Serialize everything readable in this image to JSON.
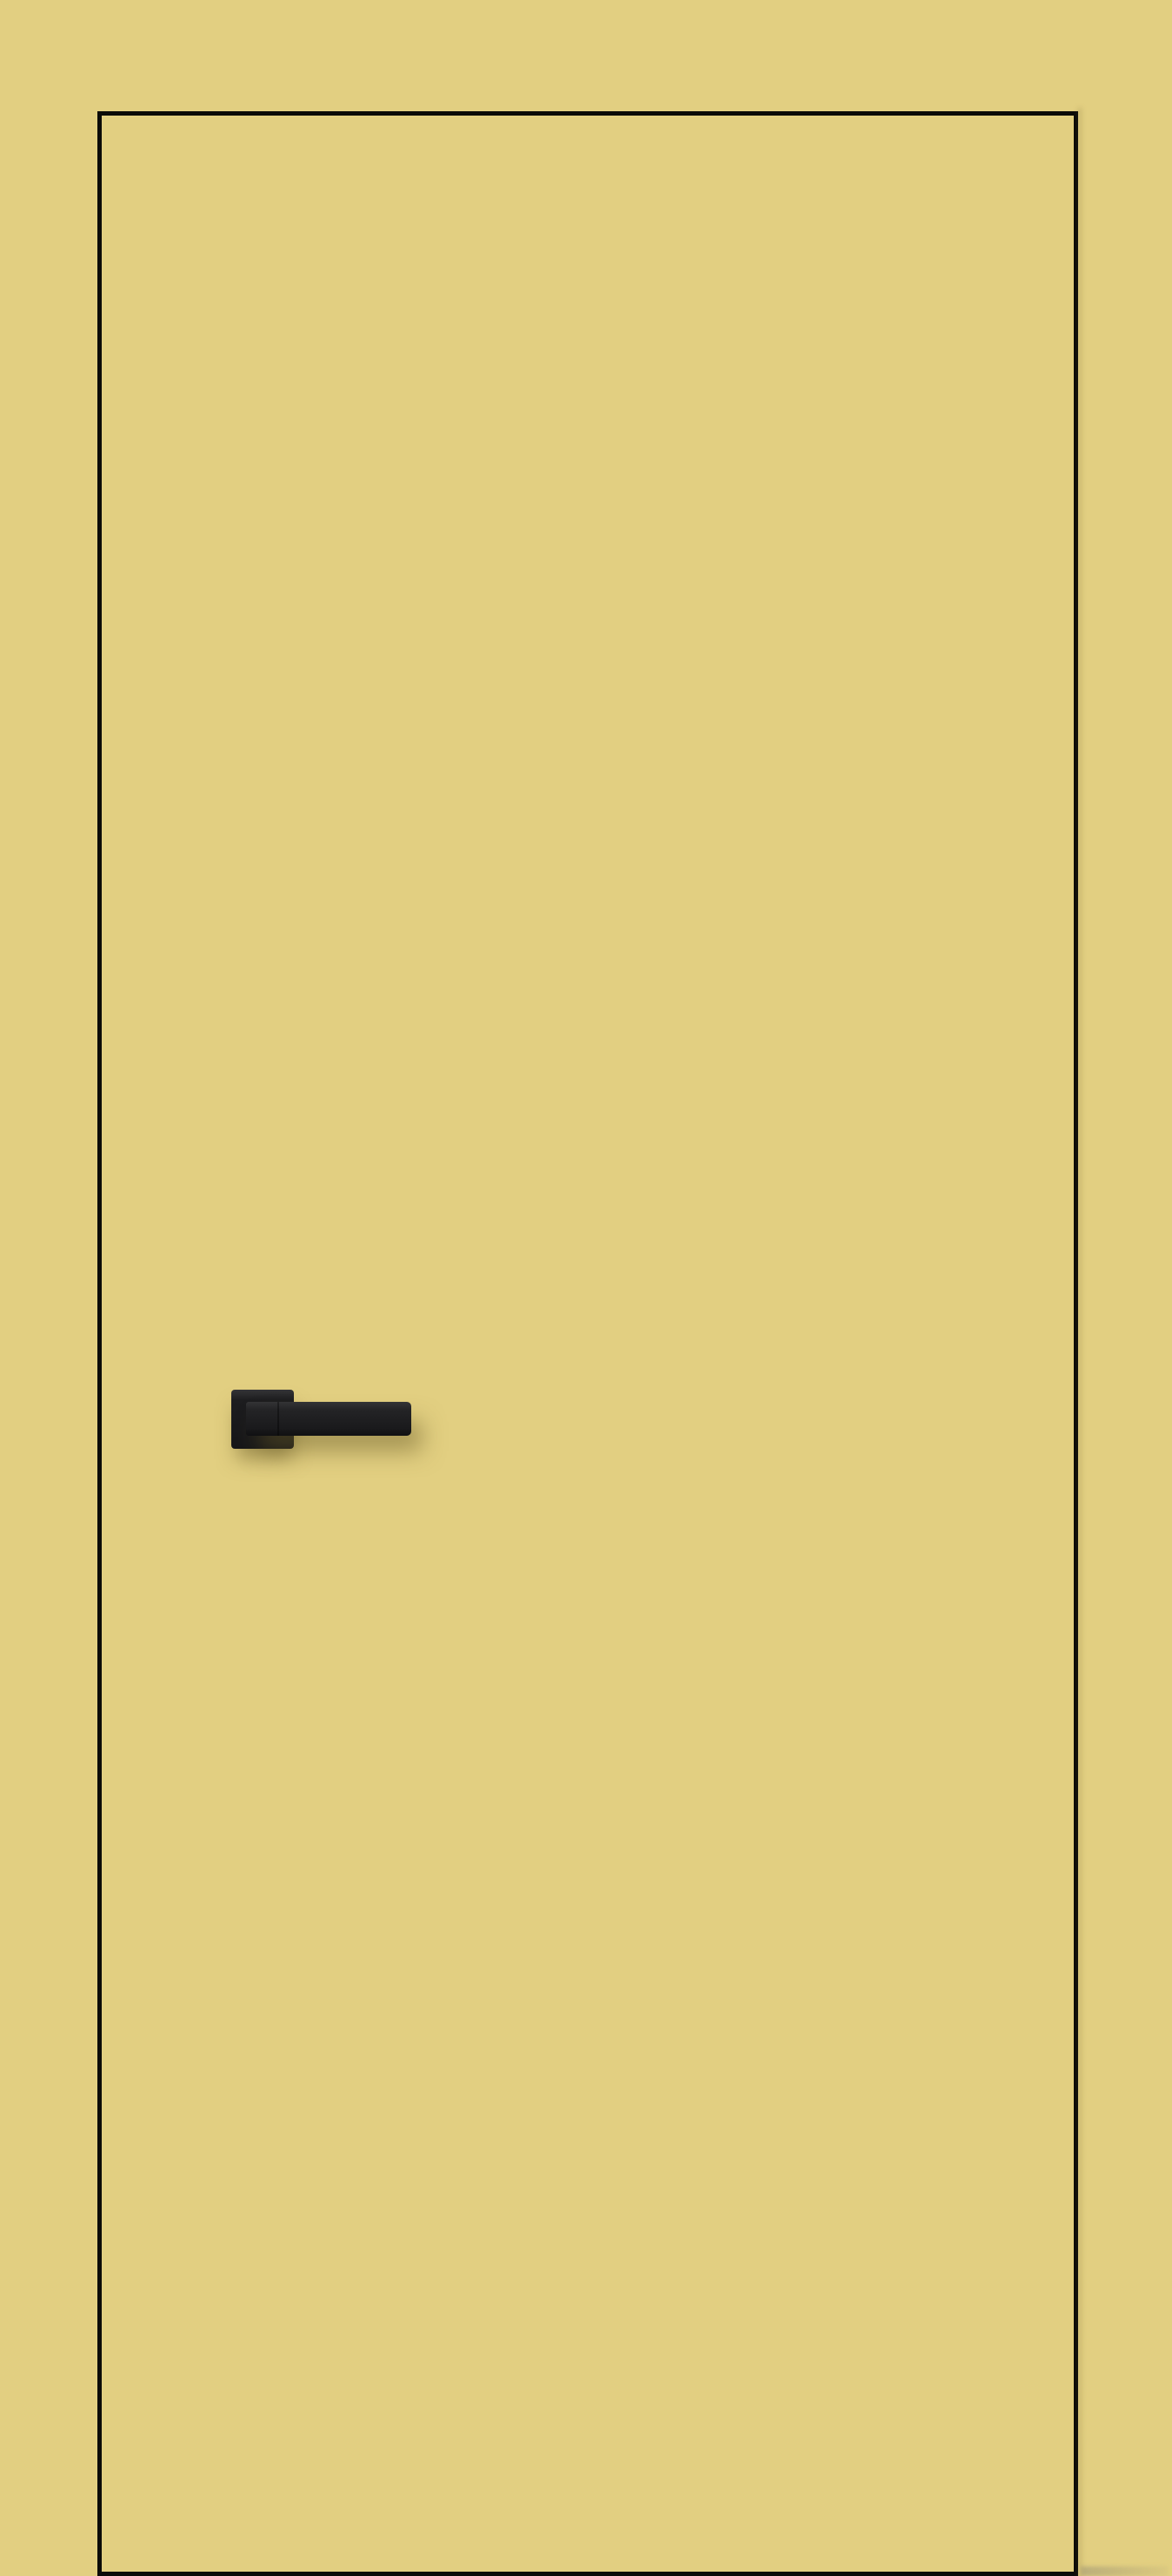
{
  "scene": {
    "description": "Yellow flush interior door with concealed frame, outlined by a thin black edge line, fitted with a matte black square-rosette lever handle, photographed against a wall painted the same muted yellow",
    "colors": {
      "wall": "#e2cf81",
      "door_face": "#e2cf81",
      "edge_line": "#0b0b08",
      "handle_dark": "#1d1d1f",
      "handle_mid": "#242426",
      "handle_highlight": "#343436",
      "shadow_olive": "rgba(106, 92, 40, 0.50)",
      "floor_smudge": "rgba(140, 135, 115, 0.45)"
    },
    "elements": {
      "door": "full-height door leaf, black outline on all four sides, bottom edge touching image bottom",
      "handle": "square rosette with straight bar lever pointing right, soft olive drop shadow below and right",
      "floor_smudge": "faint gray-olive streak at bottom-right of the door corner"
    }
  }
}
